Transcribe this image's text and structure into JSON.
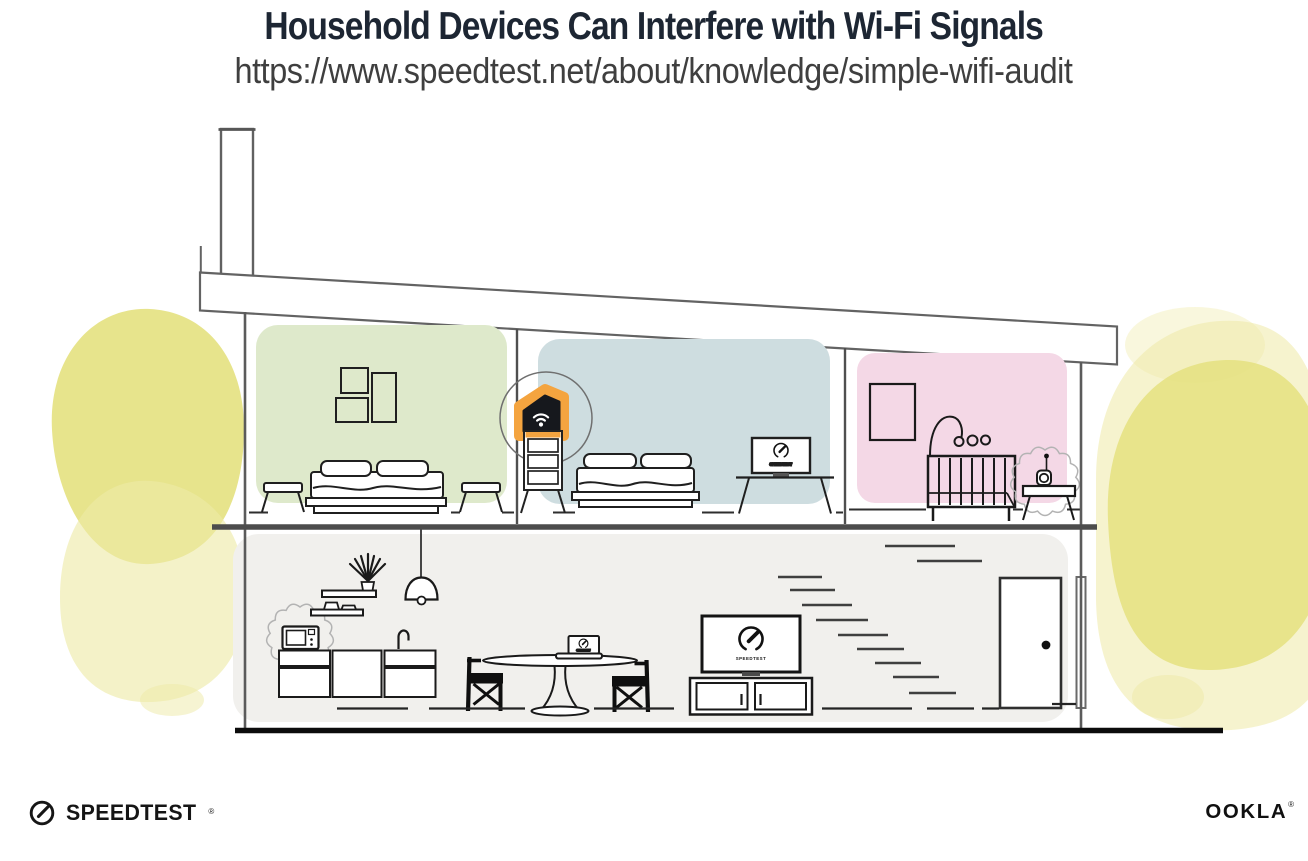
{
  "header": {
    "title": "Household Devices Can Interfere with Wi-Fi Signals",
    "url": "https://www.speedtest.net/about/knowledge/simple-wifi-audit"
  },
  "illustration": {
    "colors": {
      "bedroom_left_wall": "#dee9cb",
      "bedroom_middle_wall": "#cedde0",
      "nursery_wall": "#f4d8e6",
      "lower_floor": "#f1f0ed",
      "router_highlight": "#f4a43f",
      "foliage": "#e4e07c",
      "foliage_light": "#eeeaa6"
    },
    "labels": {
      "living_tv_screen": "SPEEDTEST",
      "bedroom_tv_screen": "SPEEDTEST",
      "laptop_screen": "SPEEDTEST"
    },
    "icons": {
      "router": "wifi-router-icon",
      "wifi": "wifi-signal-icon",
      "gauge": "speedometer-gauge-icon",
      "interference": "interference-burst-icon"
    }
  },
  "footer": {
    "speedtest_label": "SPEEDTEST",
    "speedtest_trademark": "®",
    "speedtest_icon": "speedtest-gauge-icon",
    "ookla_label": "OOKLA",
    "ookla_trademark": "®"
  }
}
